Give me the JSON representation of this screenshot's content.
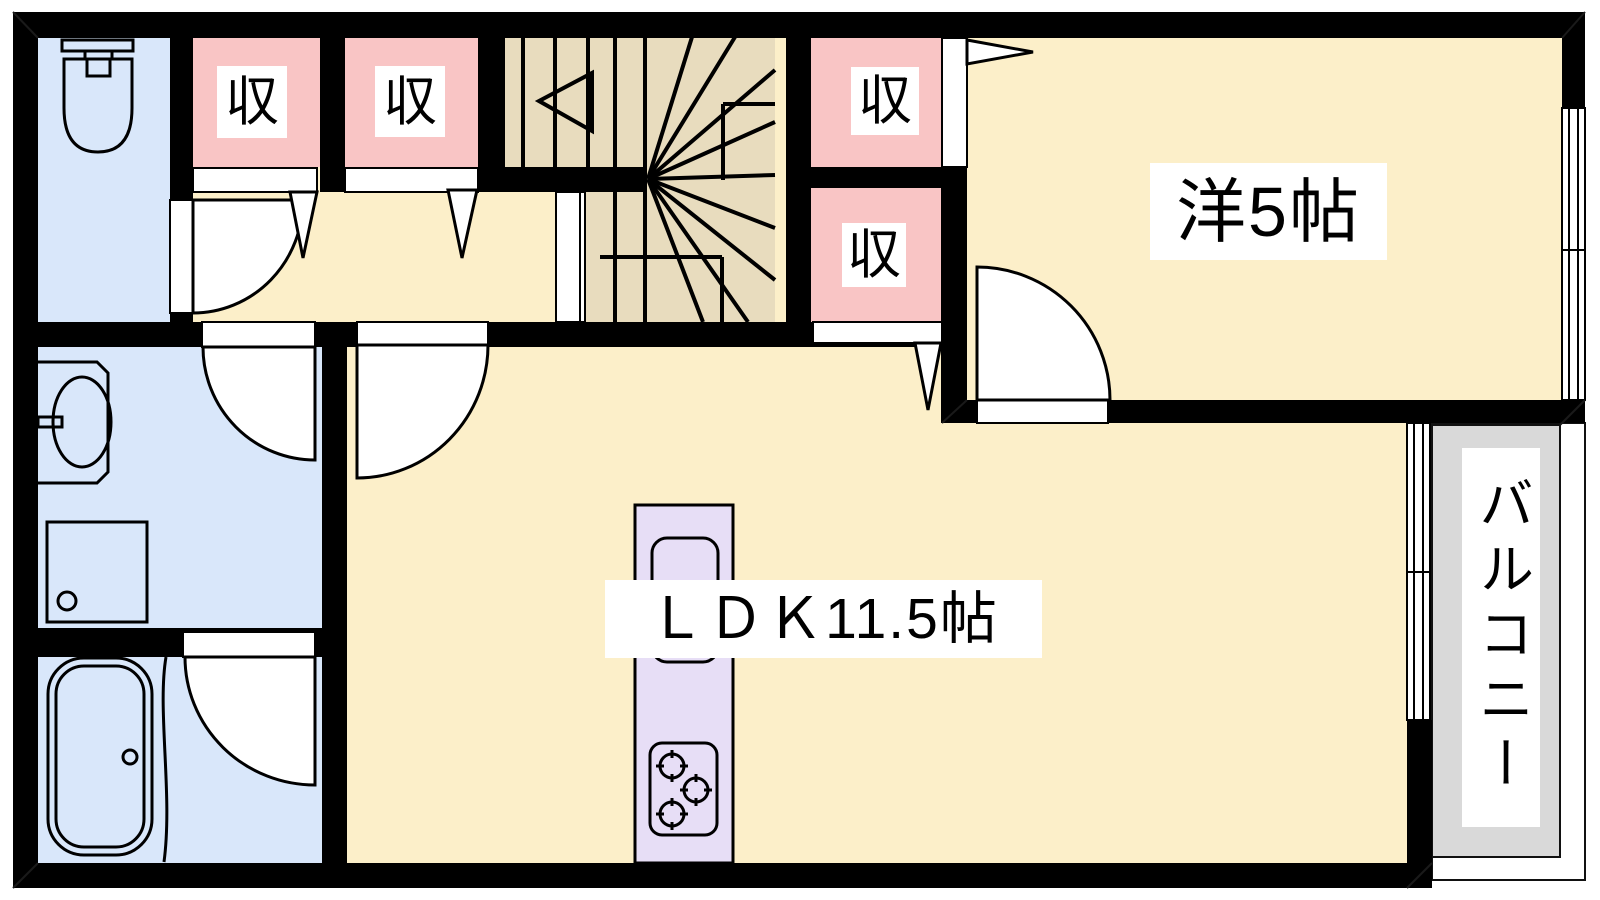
{
  "plan": {
    "kind": "japanese-apartment-floor-plan",
    "rooms": {
      "ldk": {
        "label": "ＬＤＫ11.5帖",
        "size_jo": "11.5"
      },
      "western_room": {
        "label": "洋5帖",
        "size_jo": "5"
      },
      "balcony": {
        "label": "バルコニー"
      },
      "closets": [
        "収",
        "収",
        "収",
        "収"
      ]
    },
    "fixtures": [
      "toilet-icon",
      "washbasin-icon",
      "washing-machine-pan-icon",
      "bathtub-icon",
      "kitchen-sink-icon",
      "stove-icon",
      "winding-staircase",
      "door-swing",
      "sliding-window"
    ],
    "colors": {
      "wall": "#000000",
      "floor_cream": "#FCEFC9",
      "closet_pink": "#F9C5C5",
      "sanitary_blue": "#D9E7FA",
      "stairs_tan": "#E8DCBE",
      "kitchen_lavender": "#E7DEF6",
      "balcony_gray": "#D9D9D9",
      "label_background": "#FFFFFF",
      "label_text": "#000000"
    }
  }
}
